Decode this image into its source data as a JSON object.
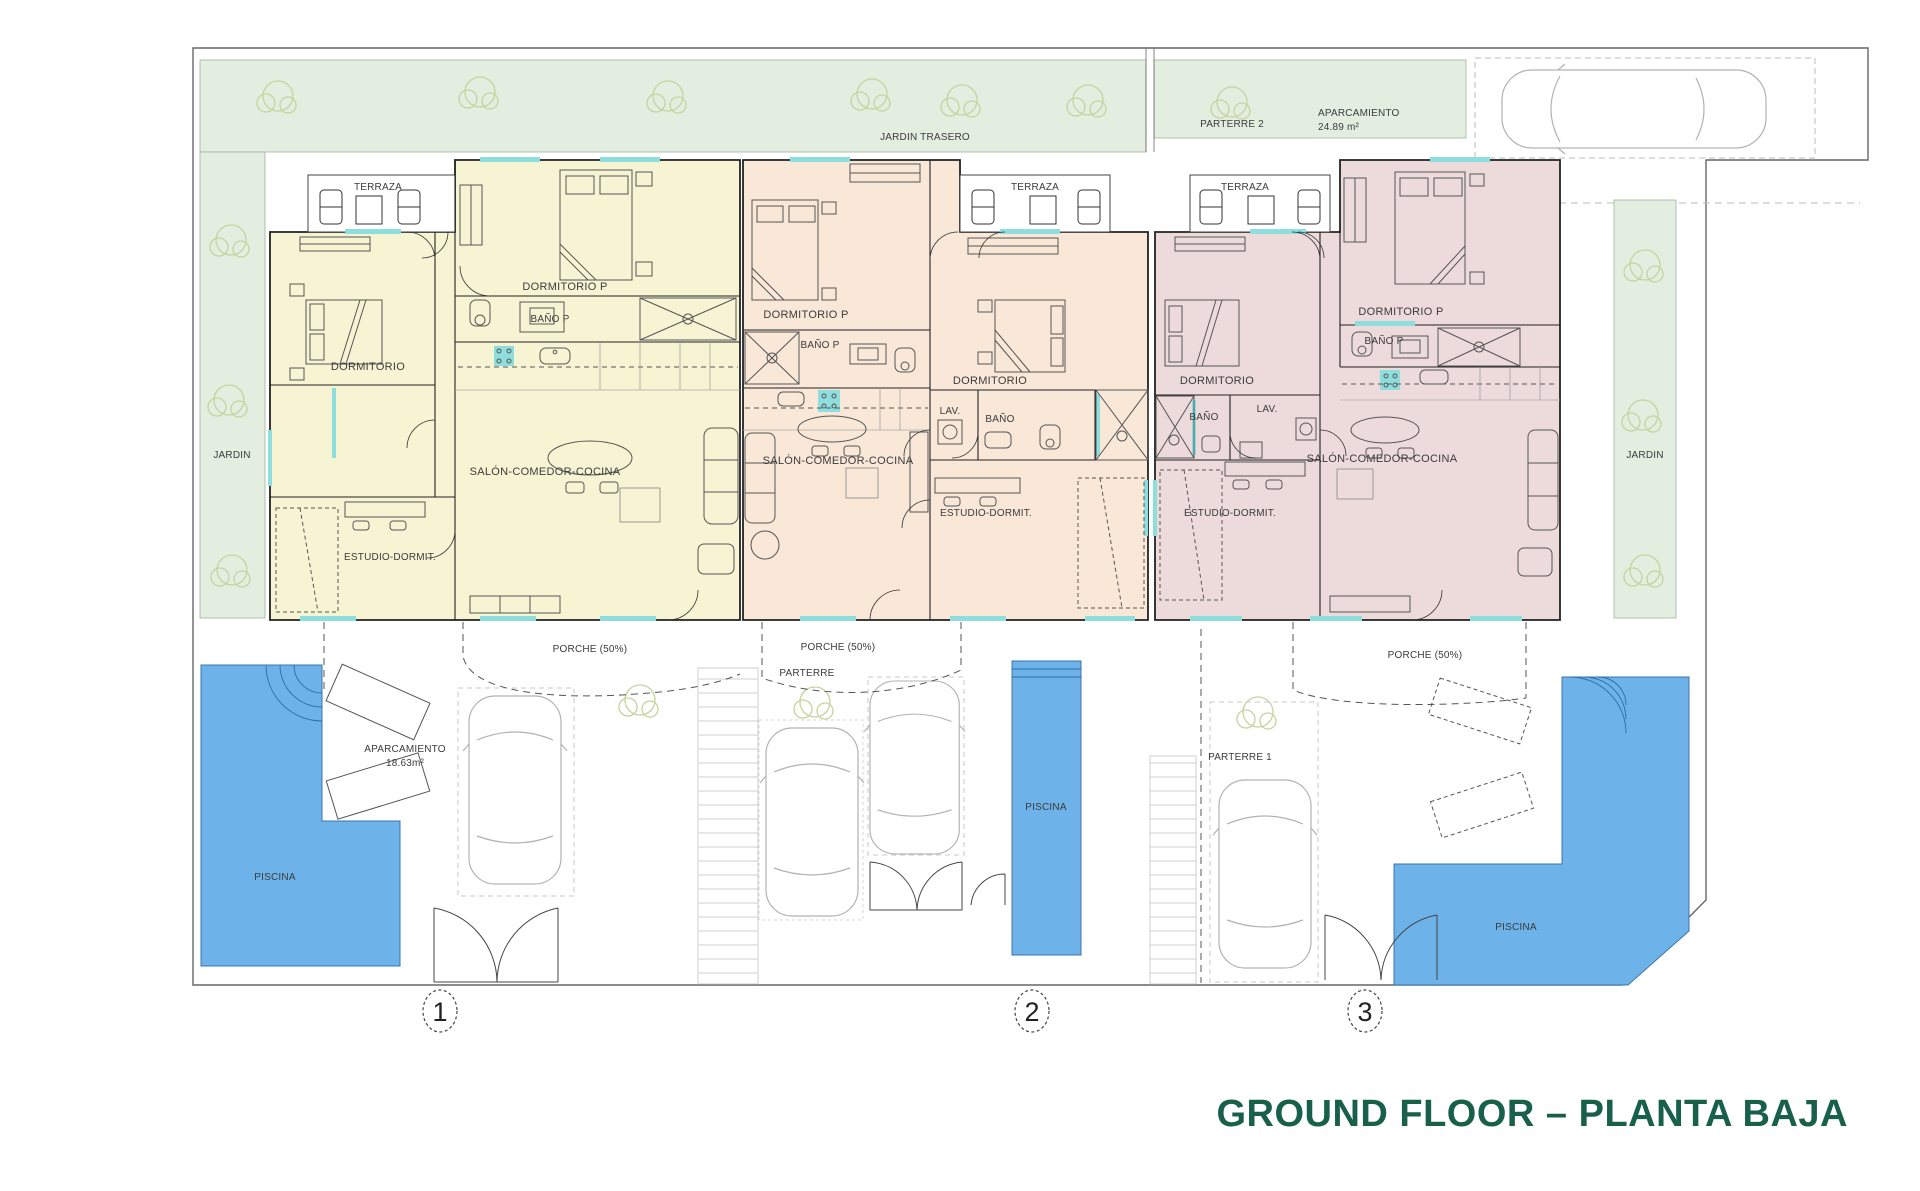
{
  "title": {
    "text": "GROUND FLOOR – PLANTA BAJA"
  },
  "colors": {
    "unit1_fill": "#f7f4d4",
    "unit2_fill": "#f9e7d8",
    "unit3_fill": "#eddadb",
    "garden_fill": "#e3eee1",
    "pool_fill": "#6db3e9",
    "window_accent": "#8fdede",
    "title_green": "#18604a"
  },
  "site": {
    "jardin_trasero": "JARDIN TRASERO",
    "parterre_2": "PARTERRE 2",
    "aparcamiento_top_line1": "APARCAMIENTO",
    "aparcamiento_top_line2": "24.89 m²",
    "jardin": "JARDIN",
    "porche": "PORCHE (50%)",
    "parterre": "PARTERRE",
    "parterre_1": "PARTERRE 1",
    "aparcamiento_1_line1": "APARCAMIENTO",
    "aparcamiento_1_line2": "18.63m²",
    "piscina": "PISCINA"
  },
  "units": [
    {
      "number": "1",
      "terraza": "TERRAZA",
      "rooms": {
        "dormitorio_p": "DORMITORIO P",
        "bano_p": "BAÑO P",
        "dormitorio": "DORMITORIO",
        "salon": "SALÓN-COMEDOR-COCINA",
        "estudio": "ESTUDIO-DORMIT."
      }
    },
    {
      "number": "2",
      "terraza": "TERRAZA",
      "rooms": {
        "dormitorio_p": "DORMITORIO P",
        "bano_p": "BAÑO P",
        "dormitorio": "DORMITORIO",
        "lav": "LAV.",
        "bano": "BAÑO",
        "salon": "SALÓN-COMEDOR-COCINA",
        "estudio": "ESTUDIO-DORMIT."
      }
    },
    {
      "number": "3",
      "terraza": "TERRAZA",
      "rooms": {
        "dormitorio_p": "DORMITORIO P",
        "bano_p": "BAÑO P",
        "dormitorio": "DORMITORIO",
        "lav": "LAV.",
        "bano": "BAÑO",
        "salon": "SALÓN-COMEDOR-COCINA",
        "estudio": "ESTUDIO-DORMIT."
      }
    }
  ]
}
